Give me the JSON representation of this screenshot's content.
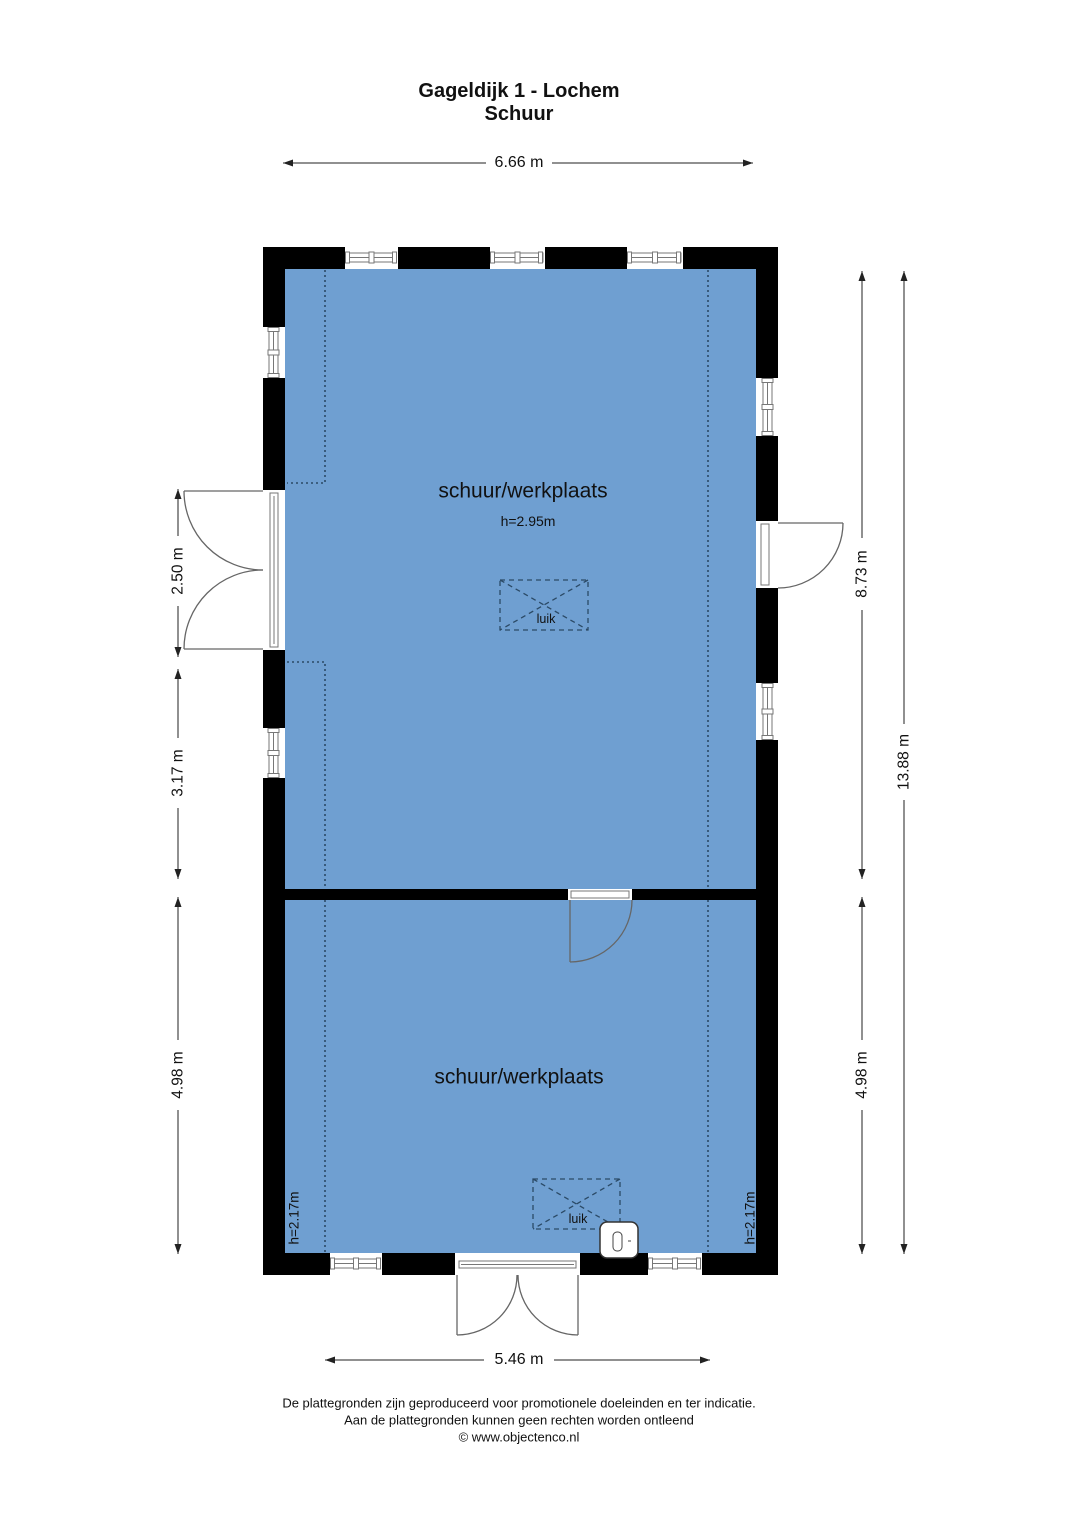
{
  "page": {
    "title_line1": "Gageldijk 1 - Lochem",
    "title_line2": "Schuur"
  },
  "rooms": {
    "upper": {
      "label": "schuur/werkplaats",
      "ceiling_height": "h=2.95m",
      "hatch": "luik"
    },
    "lower": {
      "label": "schuur/werkplaats",
      "hatch": "luik",
      "eave_height_left": "h=2.17m",
      "eave_height_right": "h=2.17m"
    }
  },
  "dimensions": {
    "top_width": "6.66 m",
    "bottom_width": "5.46 m",
    "left_segments": [
      "2.50 m",
      "3.17 m",
      "4.98 m"
    ],
    "right_segments": [
      "8.73 m",
      "4.98 m"
    ],
    "right_total": "13.88 m"
  },
  "footer": {
    "line1": "De plattegronden zijn geproduceerd voor promotionele doeleinden en ter indicatie.",
    "line2": "Aan de plattegronden kunnen geen rechten worden ontleend",
    "line3": "© www.objectenco.nl"
  },
  "colors": {
    "room_fill": "#6f9fd1",
    "wall": "#000000",
    "contour": "#2b4a66",
    "dimension": "#222222"
  }
}
